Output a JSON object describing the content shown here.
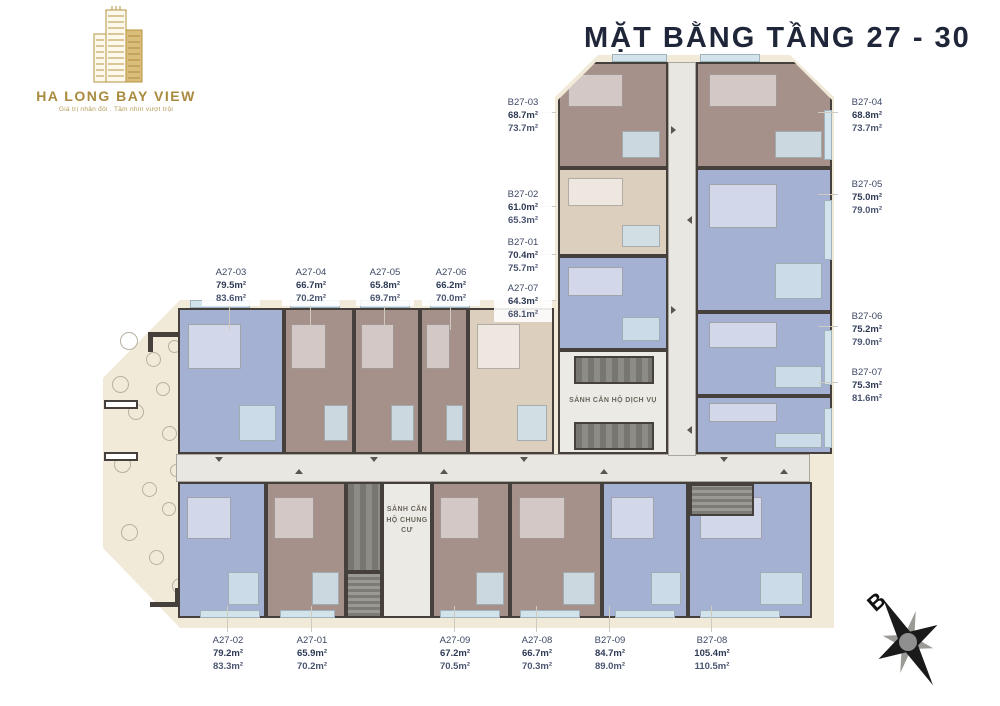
{
  "title": "MẶT BẰNG TẦNG 27 - 30",
  "logo": {
    "name": "HA LONG BAY VIEW",
    "tagline": "Giá trị nhân đôi . Tầm nhìn vượt trội"
  },
  "plan": {
    "service_lobby_label": "SẢNH CĂN HỘ DỊCH VỤ",
    "residential_lobby_label": "SẢNH CĂN HỘ CHUNG CƯ"
  },
  "compass": {
    "label": "B"
  },
  "palette": {
    "brand_gold": "#a98a3e",
    "title_navy": "#20263a",
    "label_navy": "#3d4864",
    "unit_blue": "#a4b1d3",
    "unit_brown": "#a6918a",
    "unit_tan": "#dccfbe",
    "base_beige": "#f2ead9",
    "tile_blue": "#d3e3ec",
    "wall_dark": "#45403b"
  },
  "units": [
    {
      "code": "A27-03",
      "area1": "79.5m²",
      "area2": "83.6m²"
    },
    {
      "code": "A27-04",
      "area1": "66.7m²",
      "area2": "70.2m²"
    },
    {
      "code": "A27-05",
      "area1": "65.8m²",
      "area2": "69.7m²"
    },
    {
      "code": "A27-06",
      "area1": "66.2m²",
      "area2": "70.0m²"
    },
    {
      "code": "A27-07",
      "area1": "64.3m²",
      "area2": "68.1m²"
    },
    {
      "code": "B27-03",
      "area1": "68.7m²",
      "area2": "73.7m²"
    },
    {
      "code": "B27-02",
      "area1": "61.0m²",
      "area2": "65.3m²"
    },
    {
      "code": "B27-01",
      "area1": "70.4m²",
      "area2": "75.7m²"
    },
    {
      "code": "B27-04",
      "area1": "68.8m²",
      "area2": "73.7m²"
    },
    {
      "code": "B27-05",
      "area1": "75.0m²",
      "area2": "79.0m²"
    },
    {
      "code": "B27-06",
      "area1": "75.2m²",
      "area2": "79.0m²"
    },
    {
      "code": "B27-07",
      "area1": "75.3m²",
      "area2": "81.6m²"
    },
    {
      "code": "A27-02",
      "area1": "79.2m²",
      "area2": "83.3m²"
    },
    {
      "code": "A27-01",
      "area1": "65.9m²",
      "area2": "70.2m²"
    },
    {
      "code": "A27-09",
      "area1": "67.2m²",
      "area2": "70.5m²"
    },
    {
      "code": "A27-08",
      "area1": "66.7m²",
      "area2": "70.3m²"
    },
    {
      "code": "B27-09",
      "area1": "84.7m²",
      "area2": "89.0m²"
    },
    {
      "code": "B27-08",
      "area1": "105.4m²",
      "area2": "110.5m²"
    }
  ]
}
